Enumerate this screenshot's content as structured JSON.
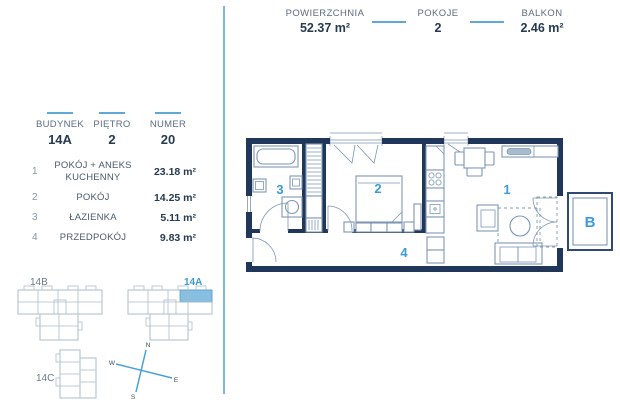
{
  "colors": {
    "accent_blue": "#3d9bd5",
    "divider_blue": "#7fb6e0",
    "wall_navy": "#21375a",
    "furniture_line": "#7d96b6",
    "unit_highlight": "#87bfe1",
    "text_dark": "#263a52",
    "text_muted": "#5c6c7f"
  },
  "header": {
    "stats": [
      {
        "label": "POWIERZCHNIA",
        "value": "52.37 m²"
      },
      {
        "label": "POKOJE",
        "value": "2"
      },
      {
        "label": "BALKON",
        "value": "2.46 m²"
      }
    ]
  },
  "unit_info": {
    "fields": [
      {
        "label": "BUDYNEK",
        "value": "14A"
      },
      {
        "label": "PIĘTRO",
        "value": "2"
      },
      {
        "label": "NUMER",
        "value": "20"
      }
    ]
  },
  "room_list": [
    {
      "no": "1",
      "name": "POKÓJ + ANEKS KUCHENNY",
      "area": "23.18 m²"
    },
    {
      "no": "2",
      "name": "POKÓJ",
      "area": "14.25 m²"
    },
    {
      "no": "3",
      "name": "ŁAZIENKA",
      "area": "5.11 m²"
    },
    {
      "no": "4",
      "name": "PRZEDPOKÓJ",
      "area": "9.83 m²"
    }
  ],
  "plan": {
    "label_1": "1",
    "label_2": "2",
    "label_3": "3",
    "label_4": "4",
    "balcony_label": "B"
  },
  "site": {
    "buildings": [
      {
        "label": "14B",
        "highlighted": false
      },
      {
        "label": "14A",
        "highlighted": true
      },
      {
        "label": "14C",
        "highlighted": false
      }
    ]
  },
  "compass": {
    "n": "N",
    "e": "E",
    "s": "S",
    "w": "W"
  }
}
